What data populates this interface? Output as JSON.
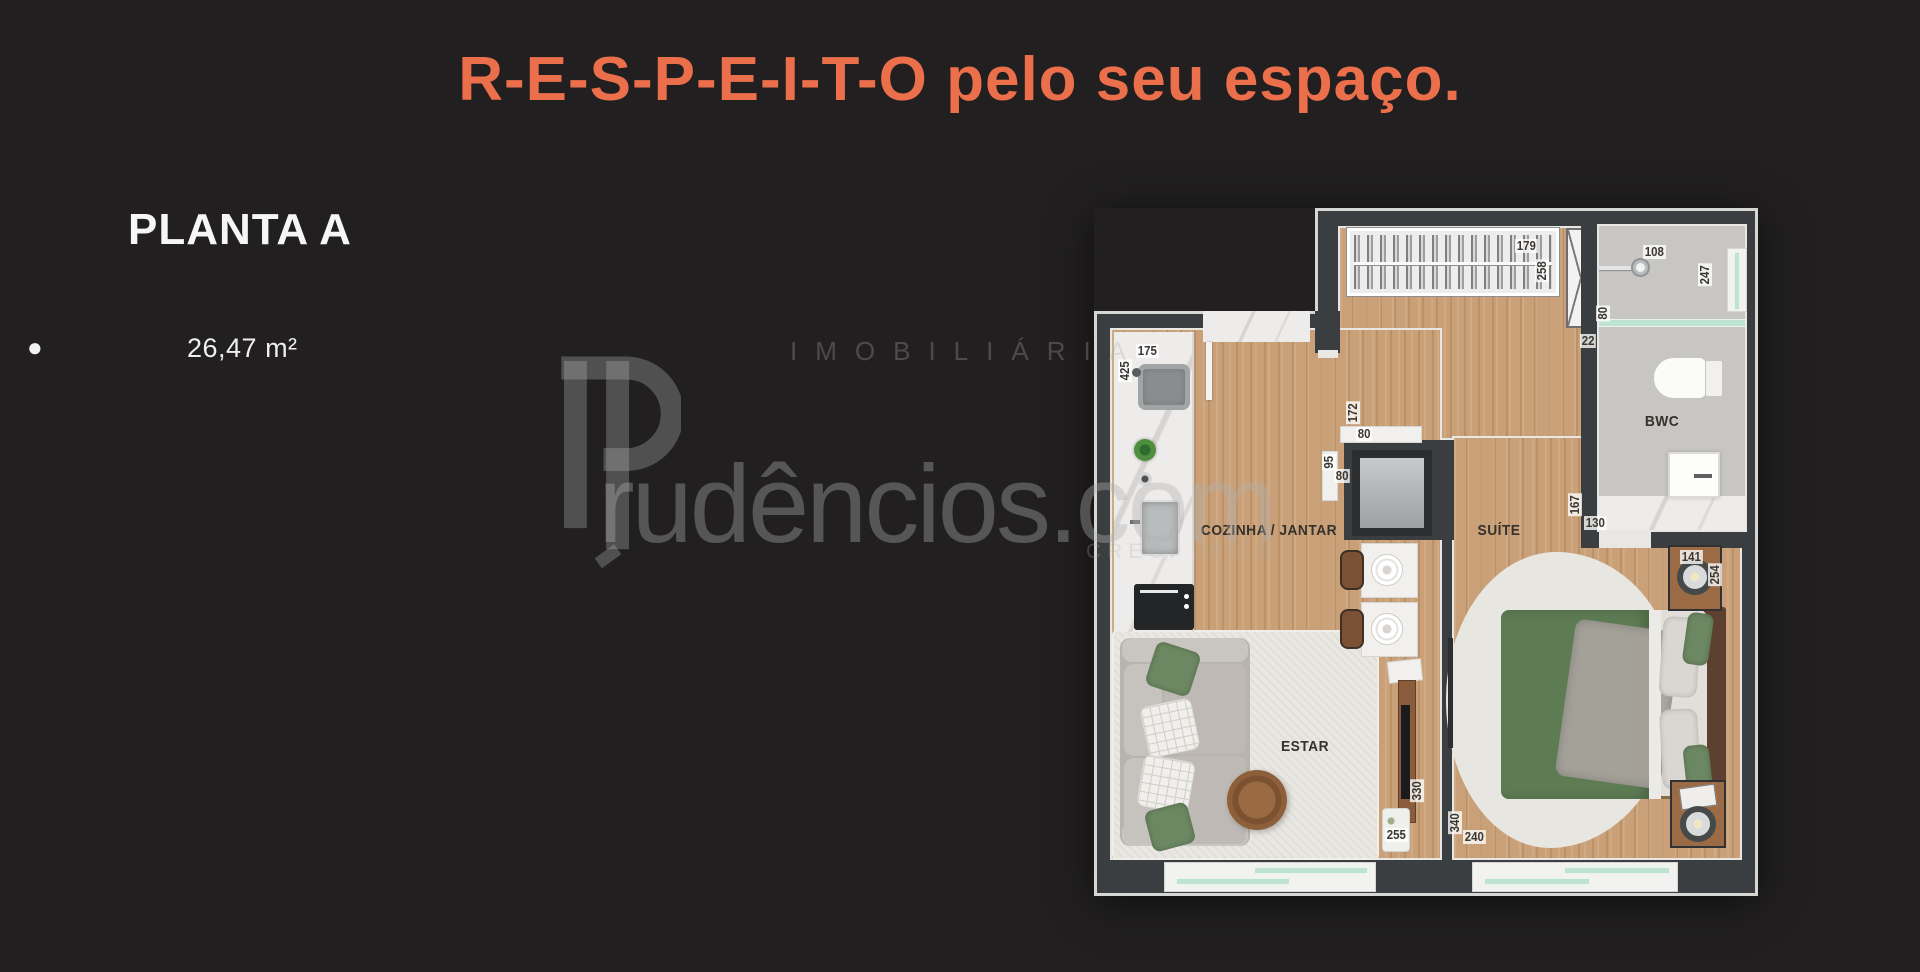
{
  "slide": {
    "title": "R-E-S-P-E-I-T-O pelo seu espaço.",
    "plan_name": "PLANTA A",
    "bullet": "●",
    "area": "26,47 m²"
  },
  "watermark": {
    "brand_rest": "rudêncios.com",
    "tagline": "IMOBILIÁRIA",
    "creci": "CRECI J06 6"
  },
  "floorplan": {
    "rooms": {
      "kitchen_dining": "COZINHA / JANTAR",
      "suite": "SUÍTE",
      "bathroom": "BWC",
      "living": "ESTAR"
    },
    "dims": {
      "closet_w": "179",
      "closet_d": "258",
      "bath_w": "108",
      "bath_d": "247",
      "niche_w": "22",
      "shower_glass": "80",
      "bench_w": "175",
      "bench_d": "425",
      "counter_d": "172",
      "counter_w": "80",
      "shelf_d": "95",
      "shelf_w": "80",
      "vanity_d": "167",
      "vanity_w": "130",
      "nightstand_w": "141",
      "nightstand_d": "254",
      "living_w": "255",
      "living_d": "330",
      "suite_d": "340",
      "suite_w": "240"
    },
    "colors": {
      "accent_orange": "#ea6f4a",
      "background": "#211f20",
      "wall": "#3b3e40",
      "wood_floor": "#c79e73",
      "bathroom_floor": "#c8c6c3",
      "window_glass": "#bfe3d2",
      "bed_green": "#5e7c54"
    }
  }
}
